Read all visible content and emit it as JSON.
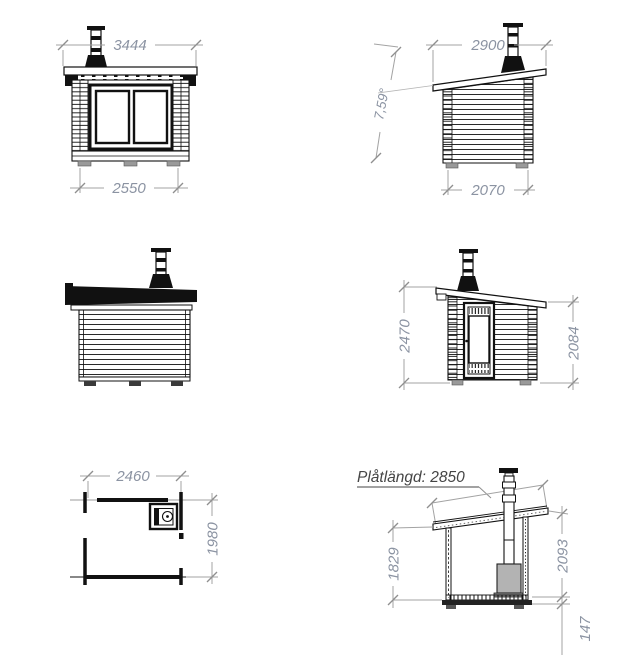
{
  "views": {
    "front": {
      "title": "front elevation",
      "dim_top": "3444",
      "dim_bottom": "2550"
    },
    "side_right": {
      "title": "right side elevation",
      "dim_top": "2900",
      "dim_bottom": "2070",
      "angle": "7,59°"
    },
    "rear": {
      "title": "rear elevation"
    },
    "side_door": {
      "title": "door side elevation",
      "dim_left": "2470",
      "dim_right": "2084"
    },
    "plan": {
      "title": "floor plan",
      "dim_width": "2460",
      "dim_depth": "1980"
    },
    "section": {
      "title": "cross section",
      "label": "Plåtlängd: 2850",
      "dim_left": "1829",
      "dim_right": "2093",
      "dim_base": "147"
    }
  },
  "colors": {
    "line": "#111111",
    "dim_line": "#a3a3a3",
    "tick": "#8f8f8f",
    "dim_text": "#8b93a2",
    "annotation_text": "#454545",
    "stove_fill": "#b3b3b3",
    "feet_fill": "#9a9a9a"
  }
}
